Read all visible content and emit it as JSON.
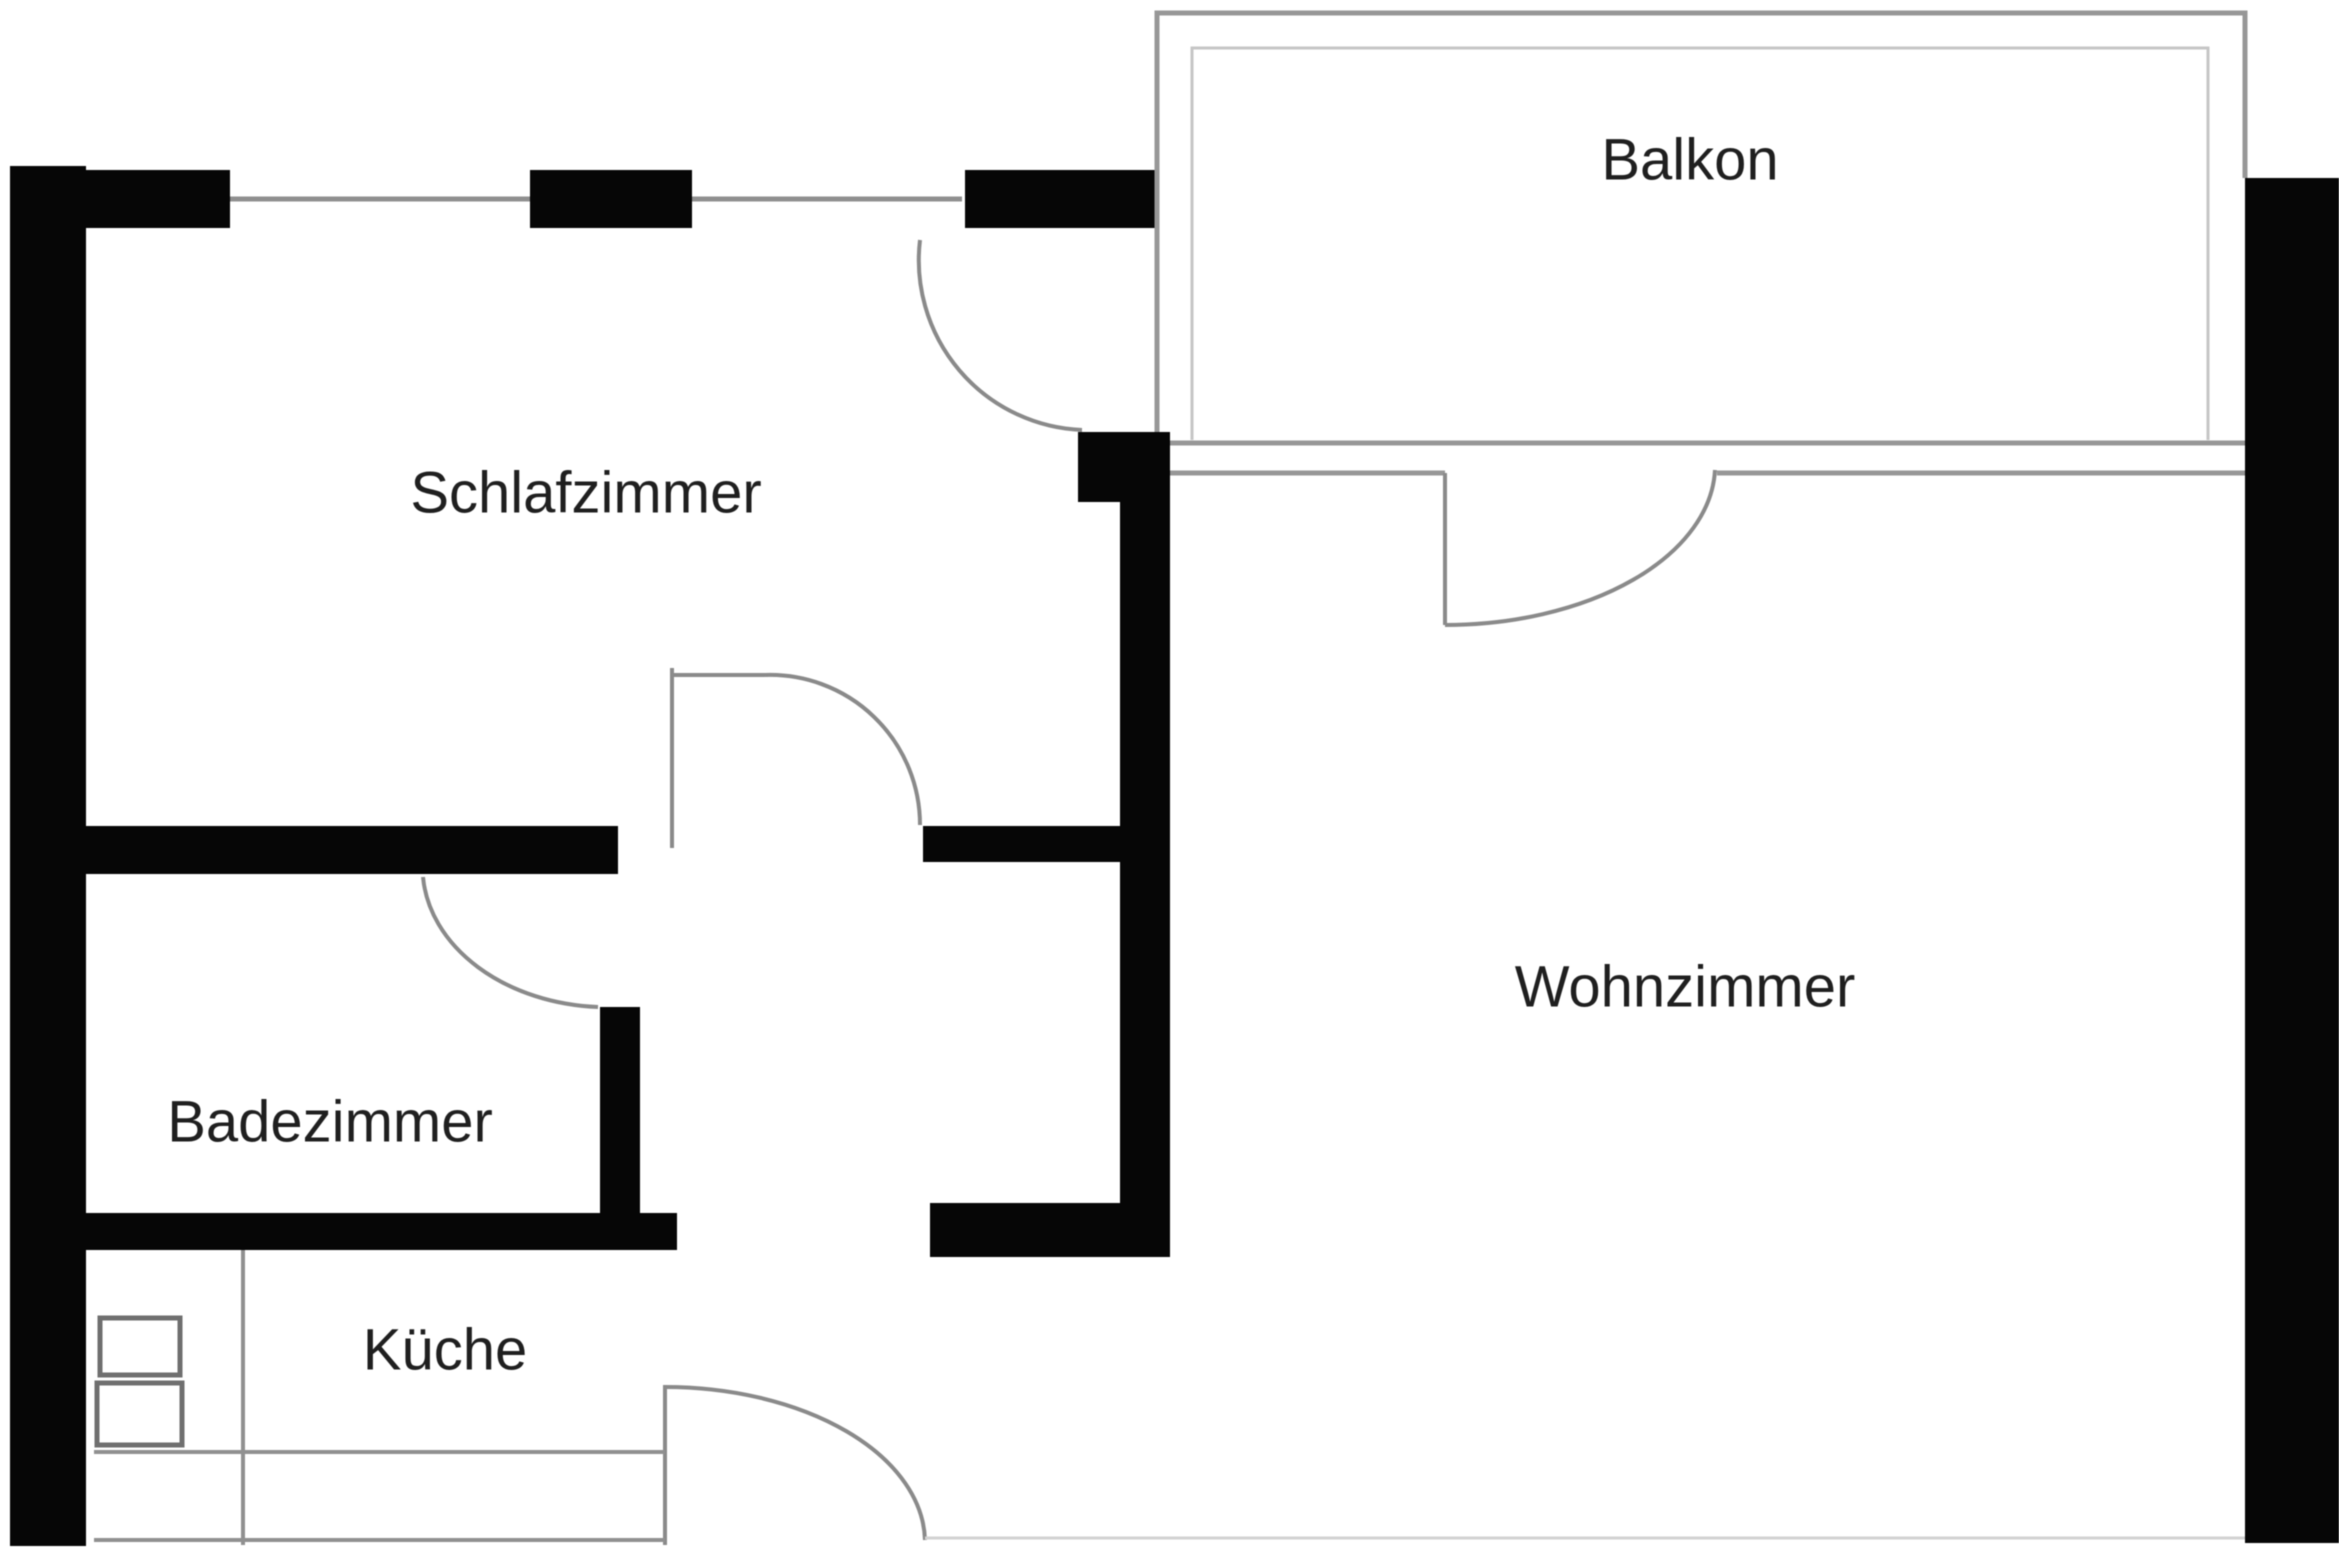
{
  "plan": {
    "type": "apartment-floor-plan",
    "language": "de"
  },
  "rooms": [
    {
      "id": "schlafzimmer",
      "label": "Schlafzimmer"
    },
    {
      "id": "balkon",
      "label": "Balkon"
    },
    {
      "id": "wohnzimmer",
      "label": "Wohnzimmer"
    },
    {
      "id": "badezimmer",
      "label": "Badezimmer"
    },
    {
      "id": "kueche",
      "label": "Küche"
    }
  ],
  "colors": {
    "background": "#ffffff",
    "wall": "#060606",
    "window_line": "#8f8f8f",
    "balcony_line": "#979797",
    "balcony_inner_line": "#c6c6c6",
    "door_line": "#8a8a8a",
    "kitchen_line": "#909090",
    "fixture_line": "#6f6f6f",
    "faint_line": "#d2d2d2",
    "label": "#1f1f1f"
  }
}
